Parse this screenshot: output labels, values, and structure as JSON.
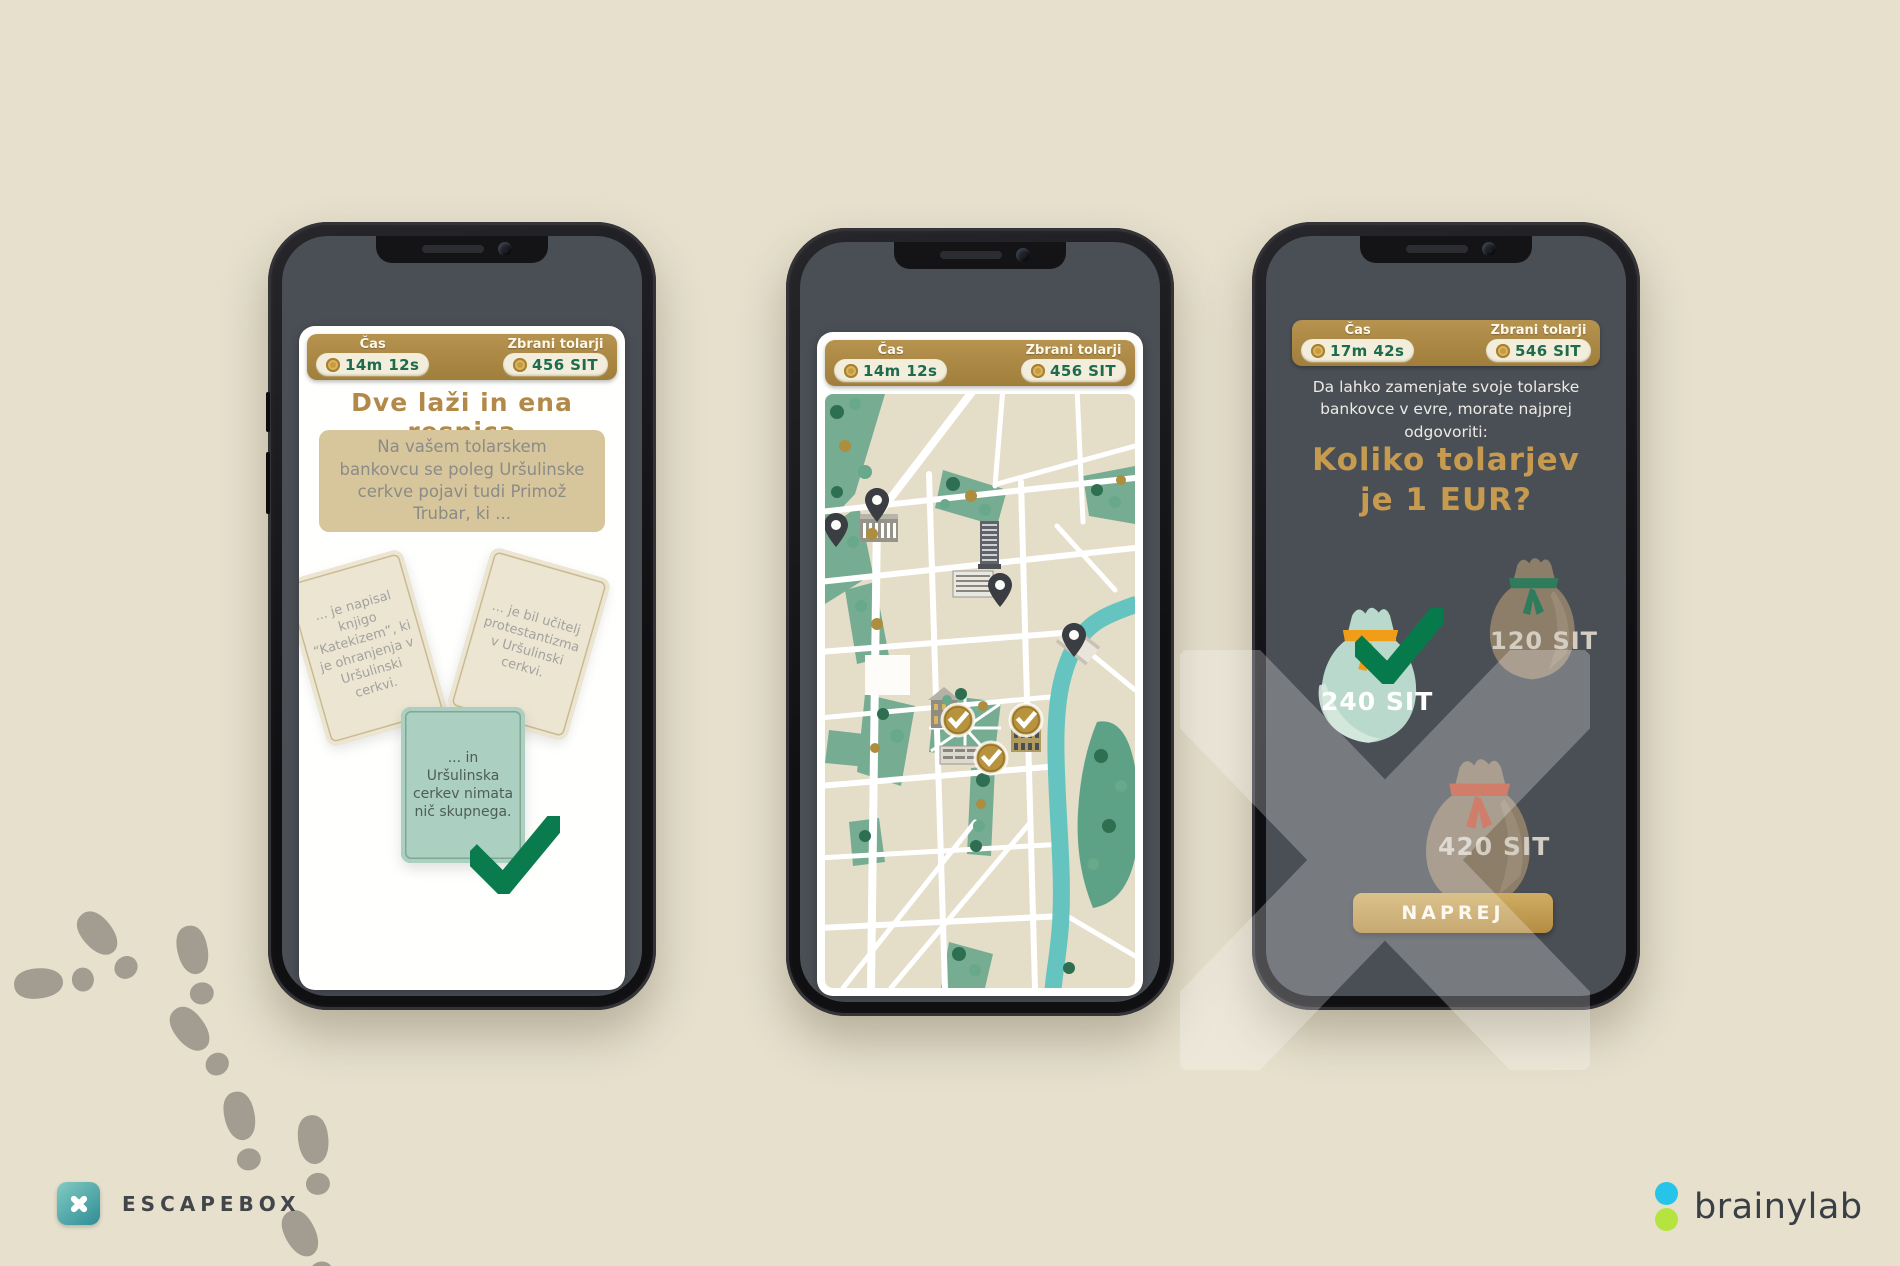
{
  "colors": {
    "background": "#e6e0cd",
    "gold": "#b3904a",
    "green_check": "#0a7b4c",
    "pill_cream": "#f3eedb",
    "pill_text_green": "#1e6b4e",
    "screen_slate": "#4a4f55",
    "park_green": "#76ac92",
    "river_teal": "#65c4bf",
    "mint_bag": "#b9d9cc",
    "brown_bag": "#8d7e6a",
    "tie_orange": "#f29d18",
    "tie_green": "#2e7c5b",
    "tie_red": "#c15138",
    "escapebox_teal": "#3f9ea0",
    "brainylab_cyan": "#27c4e9",
    "brainylab_lime": "#b5e43e"
  },
  "phone1": {
    "header": {
      "time_label": "Čas",
      "time_value": "14m 12s",
      "coins_label": "Zbrani tolarji",
      "coins_value": "456 SIT"
    },
    "title": "Dve laži in ena resnica",
    "question": "Na vašem tolarskem bankovcu se poleg Uršulinske cerkve pojavi tudi Primož Trubar, ki ...",
    "cards": [
      {
        "text": "... je napisal knjigo “Katekizem”, ki je ohranjenja v Uršulinski cerkvi.",
        "state": "default"
      },
      {
        "text": "... je bil učitelj protestantizma v Uršulinski cerkvi.",
        "state": "default"
      },
      {
        "text": "... in Uršulinska cerkev nimata nič skupnega.",
        "state": "correct"
      }
    ]
  },
  "phone2": {
    "header": {
      "time_label": "Čas",
      "time_value": "14m 12s",
      "coins_label": "Zbrani tolarji",
      "coins_value": "456 SIT"
    },
    "map": {
      "visited_checkpoints": 3,
      "pending_pins": 4
    }
  },
  "phone3": {
    "header": {
      "time_label": "Čas",
      "time_value": "17m 42s",
      "coins_label": "Zbrani tolarji",
      "coins_value": "546 SIT"
    },
    "intro": "Da lahko zamenjate svoje tolarske bankovce v evre, morate najprej odgovoriti:",
    "title_line1": "Koliko tolarjev",
    "title_line2": "je 1 EUR?",
    "options": [
      {
        "label": "240 SIT",
        "state": "correct"
      },
      {
        "label": "120 SIT",
        "state": "default"
      },
      {
        "label": "420 SIT",
        "state": "default"
      }
    ],
    "next_button": "NAPREJ"
  },
  "branding": {
    "escapebox": "ESCAPEBOX",
    "brainylab": "brainylab"
  },
  "icons": {
    "coin": "gold-coin",
    "pin": "map-pin",
    "check": "checkmark",
    "footprint": "shoe-print",
    "x_watermark": "escapebox-x"
  }
}
